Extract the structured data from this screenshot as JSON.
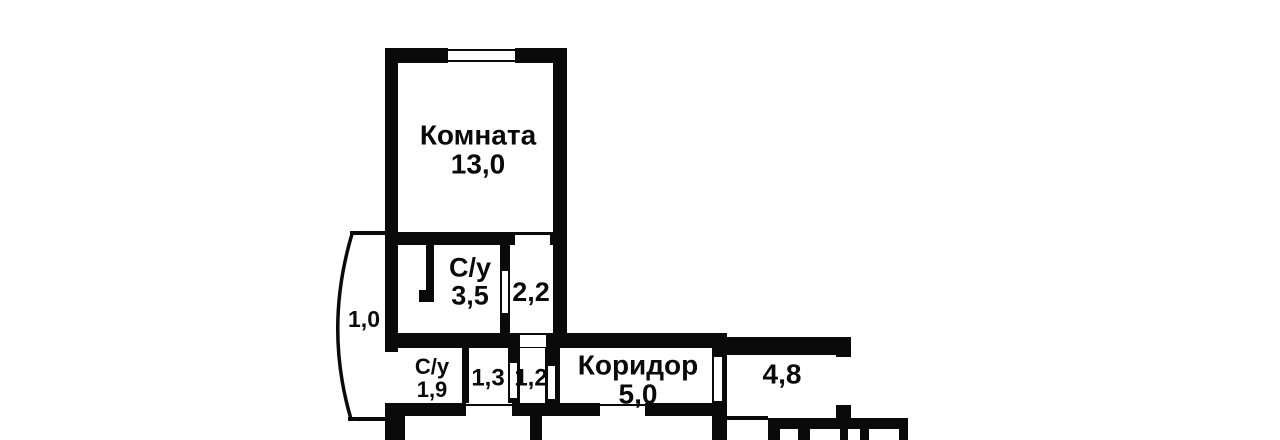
{
  "colors": {
    "wall": "#0a0a0a",
    "bg": "#ffffff",
    "text": "#0a0a0a"
  },
  "rooms": {
    "komnata": {
      "name": "Комната",
      "area": "13,0"
    },
    "su35": {
      "name": "С/у",
      "area": "3,5"
    },
    "hall22": {
      "area": "2,2"
    },
    "balcony": {
      "area": "1,0"
    },
    "su19": {
      "name": "С/у",
      "area": "1,9"
    },
    "r13": {
      "area": "1,3"
    },
    "r12": {
      "area": "1,2"
    },
    "koridor": {
      "name": "Коридор",
      "area": "5,0"
    },
    "r48": {
      "area": "4,8"
    }
  }
}
